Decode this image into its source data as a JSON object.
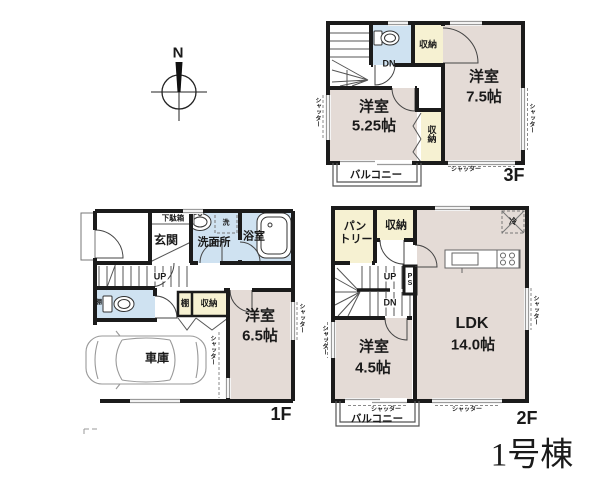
{
  "page": {
    "compass_n": "N",
    "building_label": "1号棟"
  },
  "labels": {
    "shutter": "シャッター",
    "balcony": "バルコニー",
    "storage": "収納",
    "shelf": "棚",
    "up": "UP",
    "dn": "DN",
    "ps": "PS",
    "laundry": "洗",
    "fridge": "冷",
    "shoe_cabinet": "下駄箱",
    "entrance": "玄関",
    "washroom": "洗面所",
    "bathroom": "浴室",
    "garage": "車庫",
    "pantry_line1": "パン",
    "pantry_line2": "トリー"
  },
  "floors": {
    "f1": {
      "label": "1F",
      "room_name": "洋室",
      "room_size": "6.5帖"
    },
    "f2": {
      "label": "2F",
      "ldk_name": "LDK",
      "ldk_size": "14.0帖",
      "room_name": "洋室",
      "room_size": "4.5帖"
    },
    "f3": {
      "label": "3F",
      "room_a_name": "洋室",
      "room_a_size": "5.25帖",
      "room_b_name": "洋室",
      "room_b_size": "7.5帖"
    }
  },
  "colors": {
    "wall": "#1b1b1b",
    "room_fill": "#e4dbd6",
    "closet_fill": "#f6f1d2",
    "wet_area_fill": "#cfe2f1"
  }
}
